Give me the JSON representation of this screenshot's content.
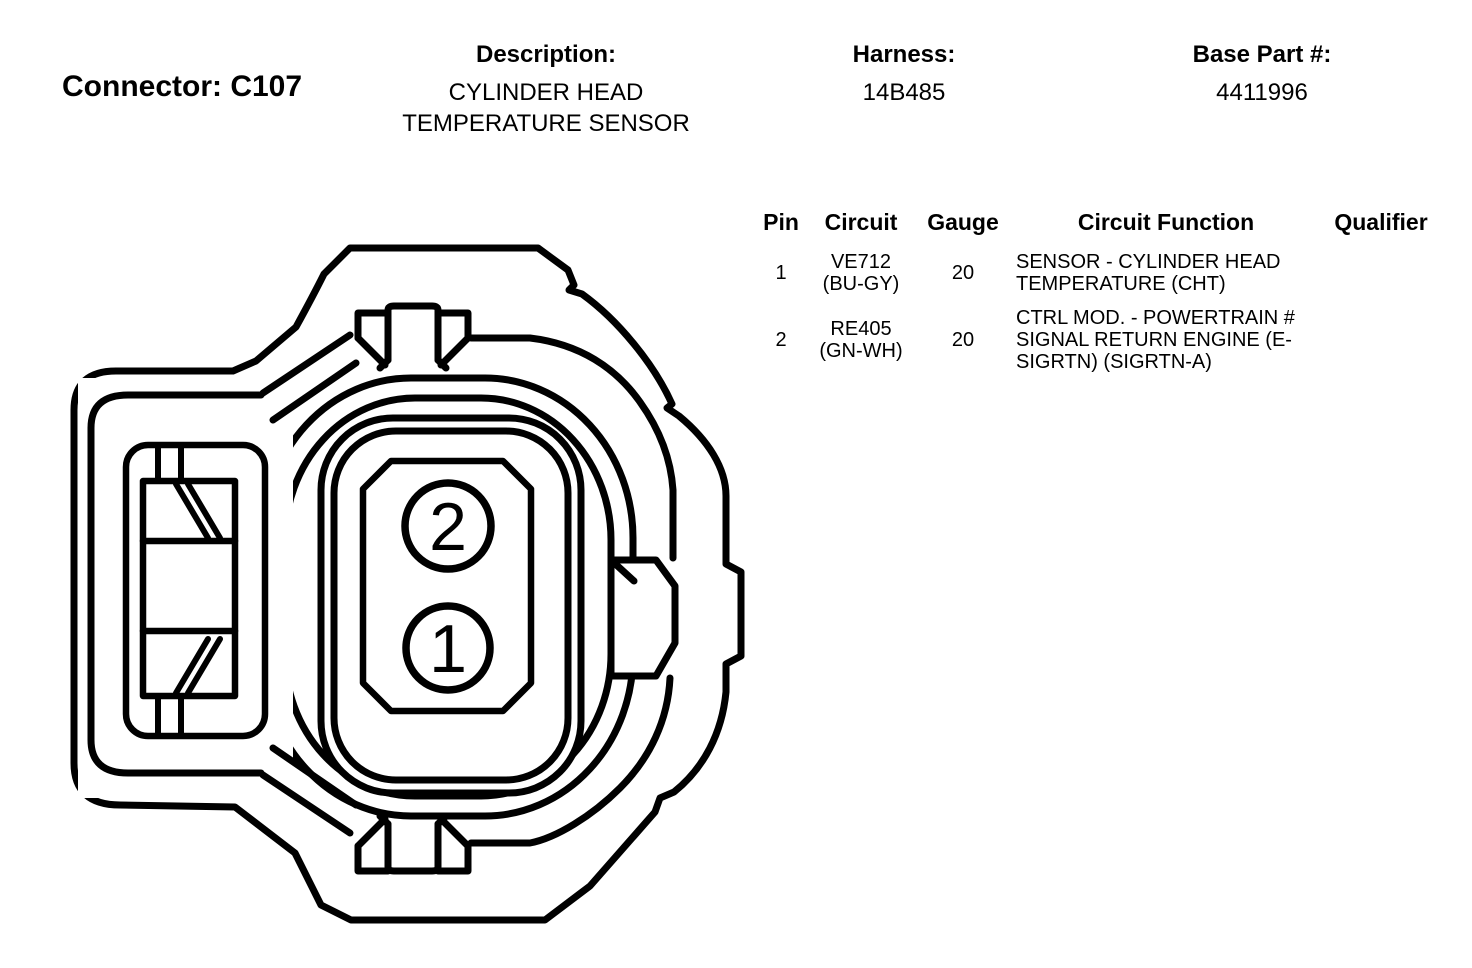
{
  "header": {
    "connector_label": "Connector: C107",
    "description_label": "Description:",
    "description_value": "CYLINDER HEAD TEMPERATURE SENSOR",
    "harness_label": "Harness:",
    "harness_value": "14B485",
    "base_part_label": "Base Part #:",
    "base_part_value": "4411996"
  },
  "pin_table": {
    "columns": [
      "Pin",
      "Circuit",
      "Gauge",
      "Circuit Function",
      "Qualifier"
    ],
    "rows": [
      {
        "pin": "1",
        "circuit_id": "VE712",
        "circuit_color": "(BU-GY)",
        "gauge": "20",
        "function": "SENSOR - CYLINDER HEAD TEMPERATURE (CHT)",
        "qualifier": ""
      },
      {
        "pin": "2",
        "circuit_id": "RE405",
        "circuit_color": "(GN-WH)",
        "gauge": "20",
        "function": "CTRL MOD. - POWERTRAIN # SIGNAL RETURN ENGINE (E-SIGRTN) (SIGRTN-A)",
        "qualifier": ""
      }
    ]
  },
  "diagram": {
    "pins": [
      "2",
      "1"
    ],
    "line_color": "#000000",
    "background": "#ffffff"
  }
}
